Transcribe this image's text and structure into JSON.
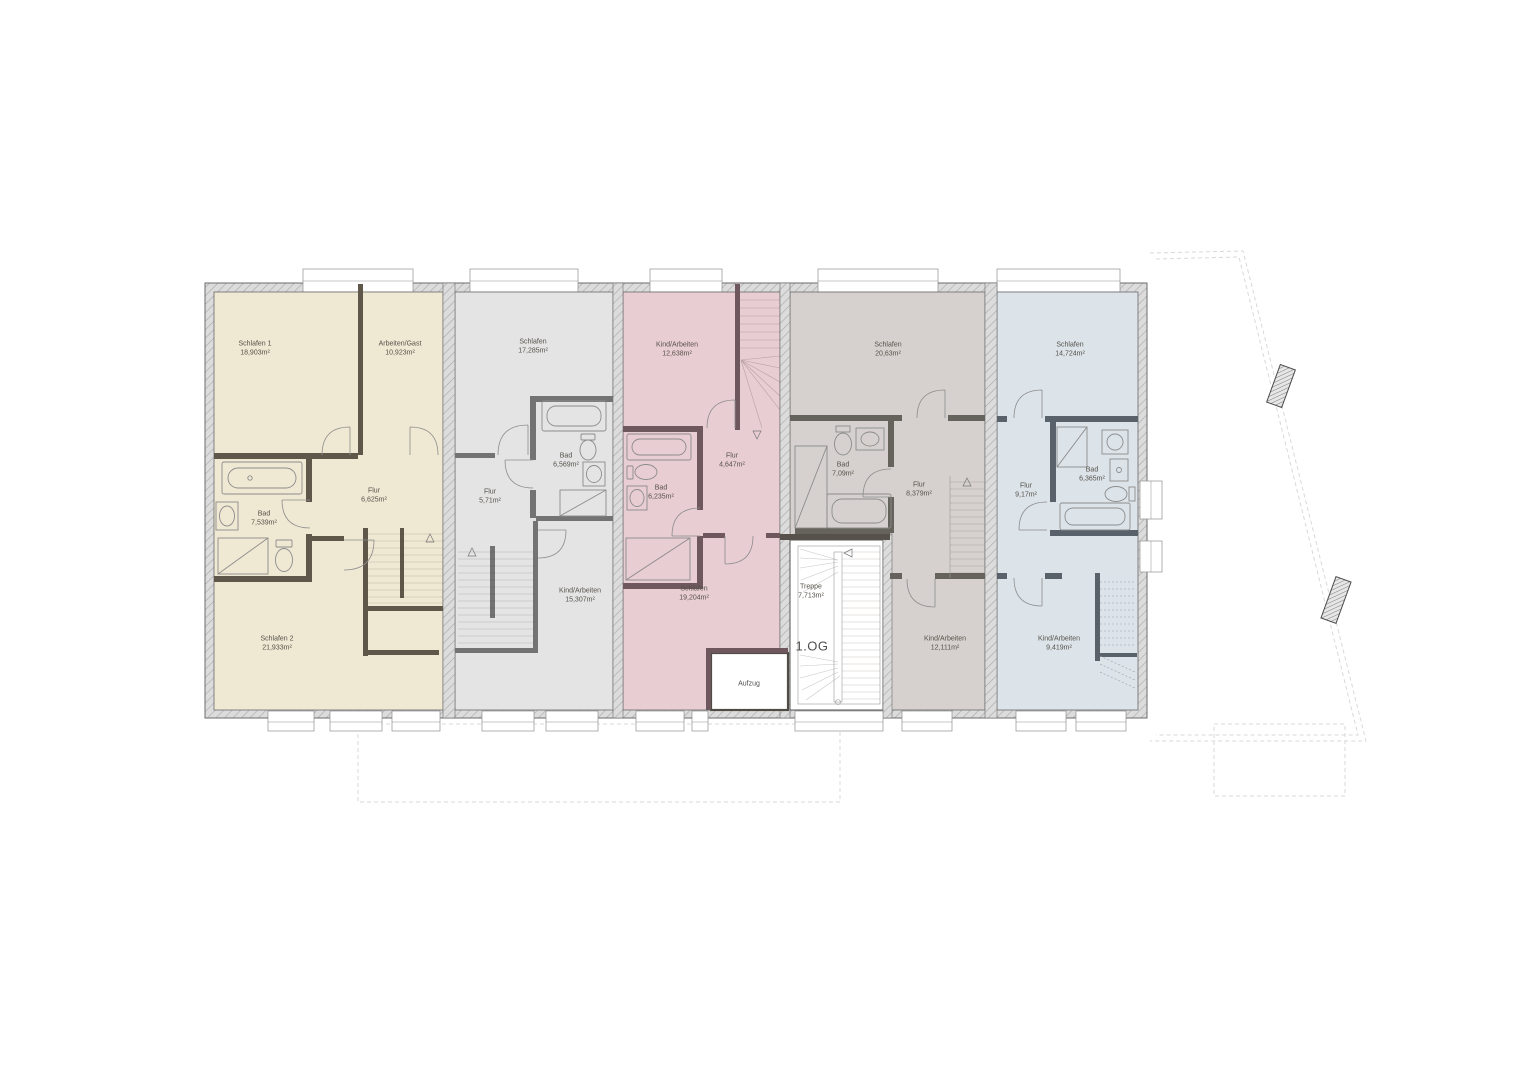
{
  "floor": {
    "label": "1.OG"
  },
  "stairwell": {
    "room_name": "Treppe",
    "room_area": "7,713m²",
    "elevator_label": "Aufzug"
  },
  "units": [
    {
      "name": "unit-1",
      "color": "#efe8d3",
      "rooms": [
        {
          "name": "Schlafen 1",
          "area": "18,903m²"
        },
        {
          "name": "Arbeiten/Gast",
          "area": "10,923m²"
        },
        {
          "name": "Flur",
          "area": "6,625m²"
        },
        {
          "name": "Bad",
          "area": "7,539m²"
        },
        {
          "name": "Schlafen 2",
          "area": "21,933m²"
        }
      ]
    },
    {
      "name": "unit-2",
      "color": "#e4e4e5",
      "rooms": [
        {
          "name": "Schlafen",
          "area": "17,285m²"
        },
        {
          "name": "Bad",
          "area": "6,569m²"
        },
        {
          "name": "Flur",
          "area": "5,71m²"
        },
        {
          "name": "Kind/Arbeiten",
          "area": "15,307m²"
        }
      ]
    },
    {
      "name": "unit-3",
      "color": "#e8cdd2",
      "rooms": [
        {
          "name": "Kind/Arbeiten",
          "area": "12,638m²"
        },
        {
          "name": "Flur",
          "area": "4,647m²"
        },
        {
          "name": "Bad",
          "area": "6,235m²"
        },
        {
          "name": "Schlafen",
          "area": "19,204m²"
        }
      ]
    },
    {
      "name": "unit-4",
      "color": "#d6d1ce",
      "rooms": [
        {
          "name": "Schlafen",
          "area": "20,63m²"
        },
        {
          "name": "Bad",
          "area": "7,09m²"
        },
        {
          "name": "Flur",
          "area": "8,379m²"
        },
        {
          "name": "Kind/Arbeiten",
          "area": "12,111m²"
        }
      ]
    },
    {
      "name": "unit-5",
      "color": "#dce3e9",
      "rooms": [
        {
          "name": "Schlafen",
          "area": "14,724m²"
        },
        {
          "name": "Flur",
          "area": "9,17m²"
        },
        {
          "name": "Bad",
          "area": "6,365m²"
        },
        {
          "name": "Kind/Arbeiten",
          "area": "9,419m²"
        }
      ]
    }
  ]
}
